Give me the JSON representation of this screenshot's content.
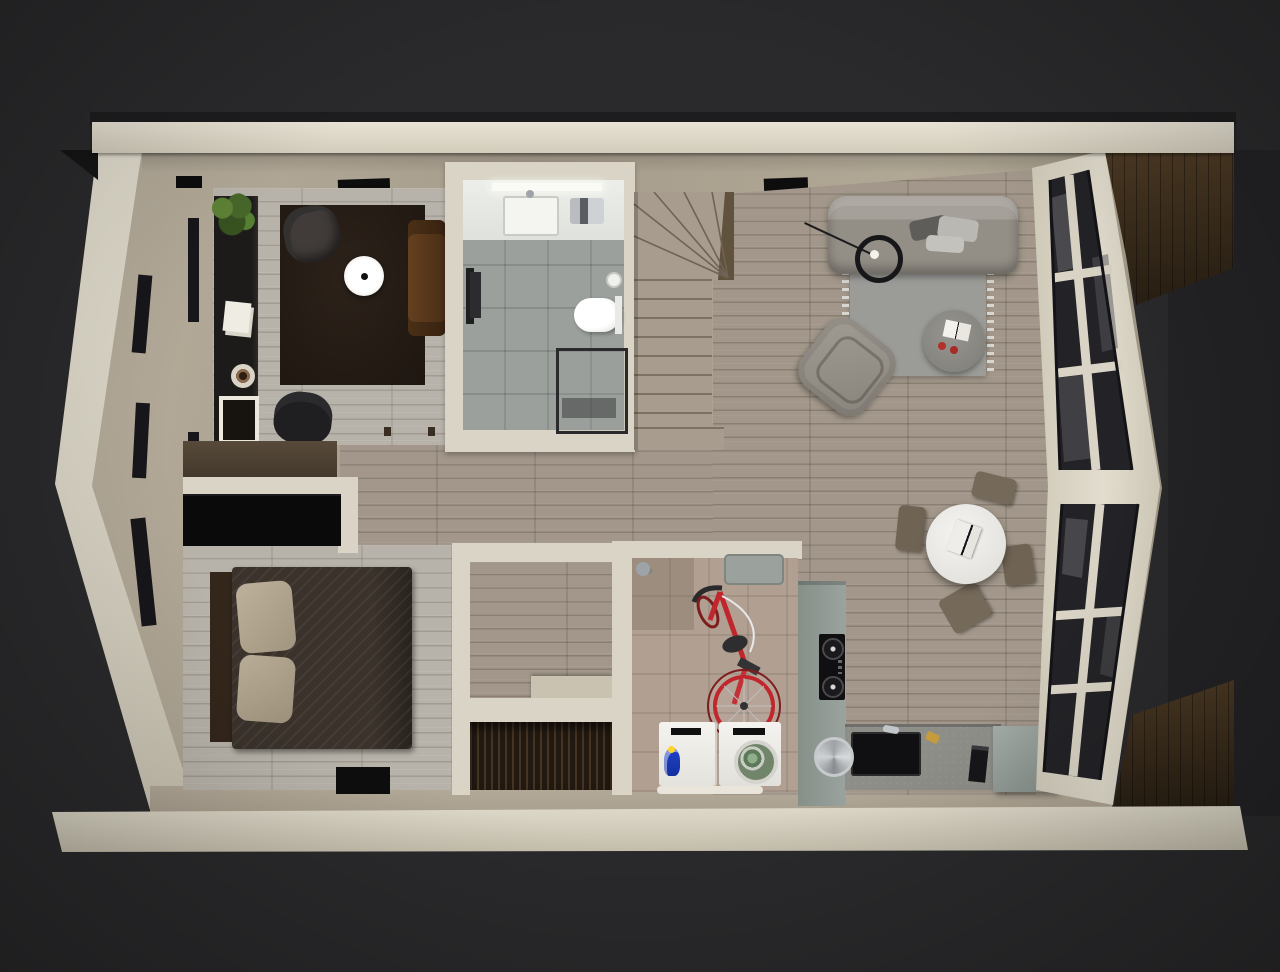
{
  "scene": {
    "type": "3d-floor-plan-render",
    "view": "top-down dollhouse cutaway",
    "background": "dark charcoal studio",
    "rooms": [
      {
        "name": "home-office",
        "position": "top-left",
        "furniture": [
          "sideboard-shelf",
          "potted-plant",
          "papers",
          "coffee-cup",
          "printer",
          "dark-area-rug",
          "armchair",
          "round-side-table",
          "leather-bench",
          "office-chair",
          "wall-desk"
        ]
      },
      {
        "name": "bathroom",
        "position": "top-center",
        "furniture": [
          "vanity-counter",
          "sink",
          "toilet",
          "towel-rail",
          "shower-enclosure",
          "toilet-paper-holder"
        ]
      },
      {
        "name": "staircase",
        "position": "center-top",
        "detail": "L-shaped winder stair"
      },
      {
        "name": "living-room",
        "position": "top-right",
        "furniture": [
          "three-seat-sofa",
          "throw-pillows",
          "arc-floor-lamp",
          "fringed-rug",
          "round-coffee-table",
          "open-book",
          "two-apples",
          "swivel-lounge-chair"
        ]
      },
      {
        "name": "dining-area",
        "position": "right",
        "furniture": [
          "round-white-table",
          "laptop",
          "dining-chair-x4"
        ]
      },
      {
        "name": "kitchen",
        "position": "bottom-right",
        "furniture": [
          "tall-cabinet-panel",
          "cooktop",
          "black-sink",
          "round-dish",
          "knife-block",
          "cabinet-box"
        ]
      },
      {
        "name": "utility-laundry",
        "position": "bottom-center",
        "furniture": [
          "shower-head",
          "storage-bin",
          "red-bicycle",
          "washing-machine",
          "dryer-with-laundry",
          "detergent-bottle",
          "threshold-strip"
        ]
      },
      {
        "name": "hallway-closets",
        "position": "center",
        "furniture": [
          "closet-alcove",
          "slatted-closet",
          "door-jamb"
        ]
      },
      {
        "name": "bedroom",
        "position": "bottom-left",
        "furniture": [
          "double-bed",
          "dark-duvet",
          "pillow-x2",
          "headboard",
          "black-wardrobe",
          "door-mat"
        ]
      }
    ],
    "architecture": [
      "angled-left-facade-with-window-slits",
      "angled-right-glass-facade",
      "top-eave-band",
      "bottom-eave-band",
      "wood-deck-right",
      "ceiling-vents",
      "wall-lamp"
    ]
  },
  "colors": {
    "bg": "#2a2a2c",
    "eave-cream": "#d9d4c5",
    "wall-face-beige": "#aba291",
    "floor-plank": "#a2978a",
    "floor-plank-light": "#b8b3aa",
    "bath-tile": "#9ba09d",
    "utility-tile": "#b1a092",
    "office-rug": "#251c15",
    "sofa-gray": "#989289",
    "rug-gray": "#9b9b97",
    "dining-table-white": "#eeedea",
    "chair-taupe": "#75695a",
    "kitchen-panel": "#97a09b",
    "counter-concrete": "#8e8e88",
    "appliance-white": "#f2f1ed",
    "bike-red": "#c0262c",
    "bed-duvet": "#3a322b",
    "pillow-beige": "#b3a793",
    "wood-desk": "#4b3f31",
    "deck-wood": "#4d3a24",
    "glass-dark": "#232327",
    "detergent-blue": "#2143c8",
    "laundry-green": "#7fa27f",
    "plant-green": "#4a6b2a",
    "apple-red": "#b23128"
  }
}
